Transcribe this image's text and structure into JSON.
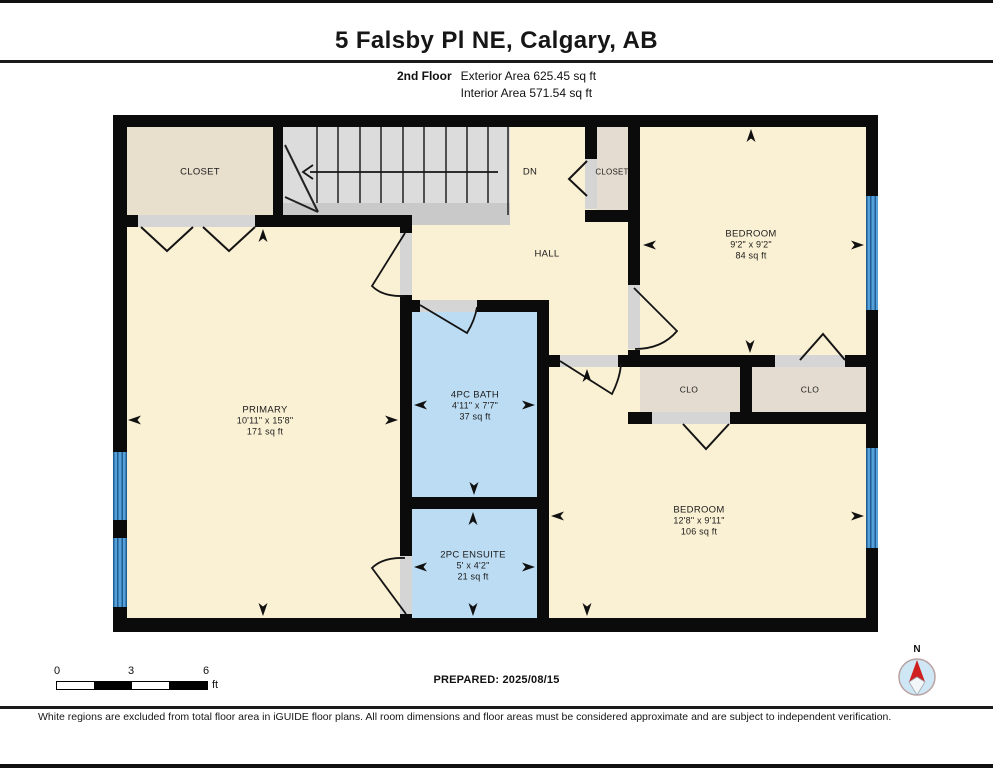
{
  "header": {
    "title": "5 Falsby Pl NE, Calgary, AB",
    "floor_label": "2nd Floor",
    "exterior_area": "Exterior Area 625.45 sq ft",
    "interior_area": "Interior Area 571.54 sq ft"
  },
  "rooms": {
    "closet_tl": {
      "name": "CLOSET"
    },
    "stairs": {
      "direction_label": "DN"
    },
    "closet_hall": {
      "name": "CLOSET"
    },
    "hall": {
      "name": "HALL"
    },
    "bedroom_tr": {
      "name": "BEDROOM",
      "dims": "9'2\" x 9'2\"",
      "area": "84 sq ft"
    },
    "primary": {
      "name": "PRIMARY",
      "dims": "10'11\" x 15'8\"",
      "area": "171 sq ft"
    },
    "bath": {
      "name": "4PC BATH",
      "dims": "4'11\" x 7'7\"",
      "area": "37 sq ft"
    },
    "ensuite": {
      "name": "2PC ENSUITE",
      "dims": "5' x 4'2\"",
      "area": "21 sq ft"
    },
    "clo_left": {
      "name": "CLO"
    },
    "clo_right": {
      "name": "CLO"
    },
    "bedroom_br": {
      "name": "BEDROOM",
      "dims": "12'8\" x 9'11\"",
      "area": "106 sq ft"
    }
  },
  "scale_bar": {
    "tick_start": "0",
    "tick_mid": "3",
    "tick_end": "6",
    "unit": "ft"
  },
  "compass": {
    "north_label": "N"
  },
  "footer": {
    "prepared": "PREPARED: 2025/08/15",
    "disclaimer": "White regions are excluded from total floor area in iGUIDE floor plans. All room dimensions and floor areas must be considered approximate and are subject to independent verification."
  },
  "colors": {
    "room_fill": "#faf0d3",
    "closet_fill": "#e8dfcd",
    "clo_fill": "#e4dcd0",
    "bath_fill": "#bcdcf3",
    "stairs_fill": "#dcdcdc",
    "wall": "#0b0b0b",
    "window_blue": "#55a0d8",
    "compass_red": "#cf1f1f"
  }
}
